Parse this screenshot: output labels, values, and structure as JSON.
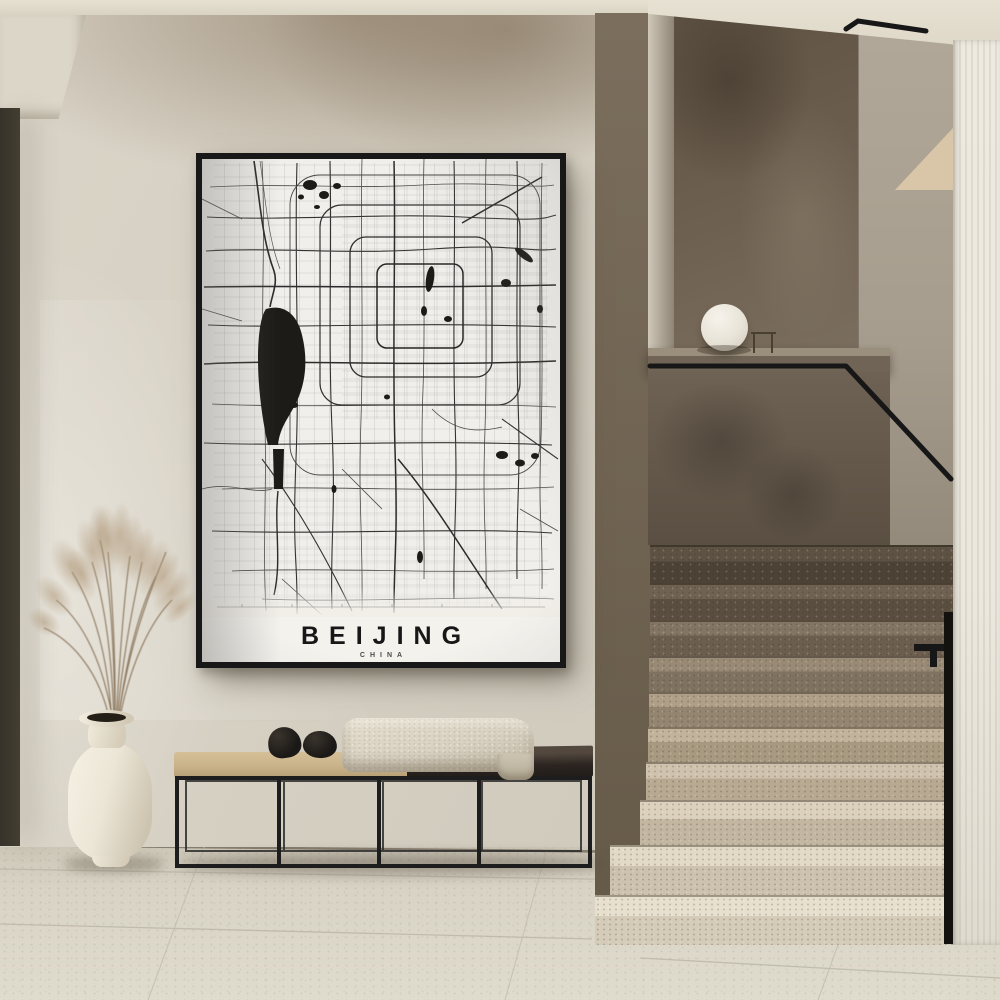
{
  "poster": {
    "title": "BEIJING",
    "subtitle": "CHINA"
  },
  "colors": {
    "wall": "#d7d1c4",
    "ceiling": "#e7e1d3",
    "soffit": "#dcd6c8",
    "door_dark": "#433e31",
    "frame": "#181818",
    "paper": "#f2efe9",
    "map_ink": "#2b2b2b",
    "water": "#1d1b18",
    "stair_dark_wall": "#6e6050",
    "stair_grey_wall": "#a79d8e",
    "wedge": "#dcc9a9",
    "pillar": "#ebe8df",
    "floor": "#d8d3c5",
    "bench_frame": "#1d1d1d",
    "cushion": "#c9b289",
    "bench_top": "#2c2521",
    "blanket": "#d8d1c2",
    "pebble": "#1b1917",
    "vase": "#ece6d7",
    "pampas": "#b0967a",
    "handrail": "#171717",
    "lamp": "#f6f3ec"
  }
}
